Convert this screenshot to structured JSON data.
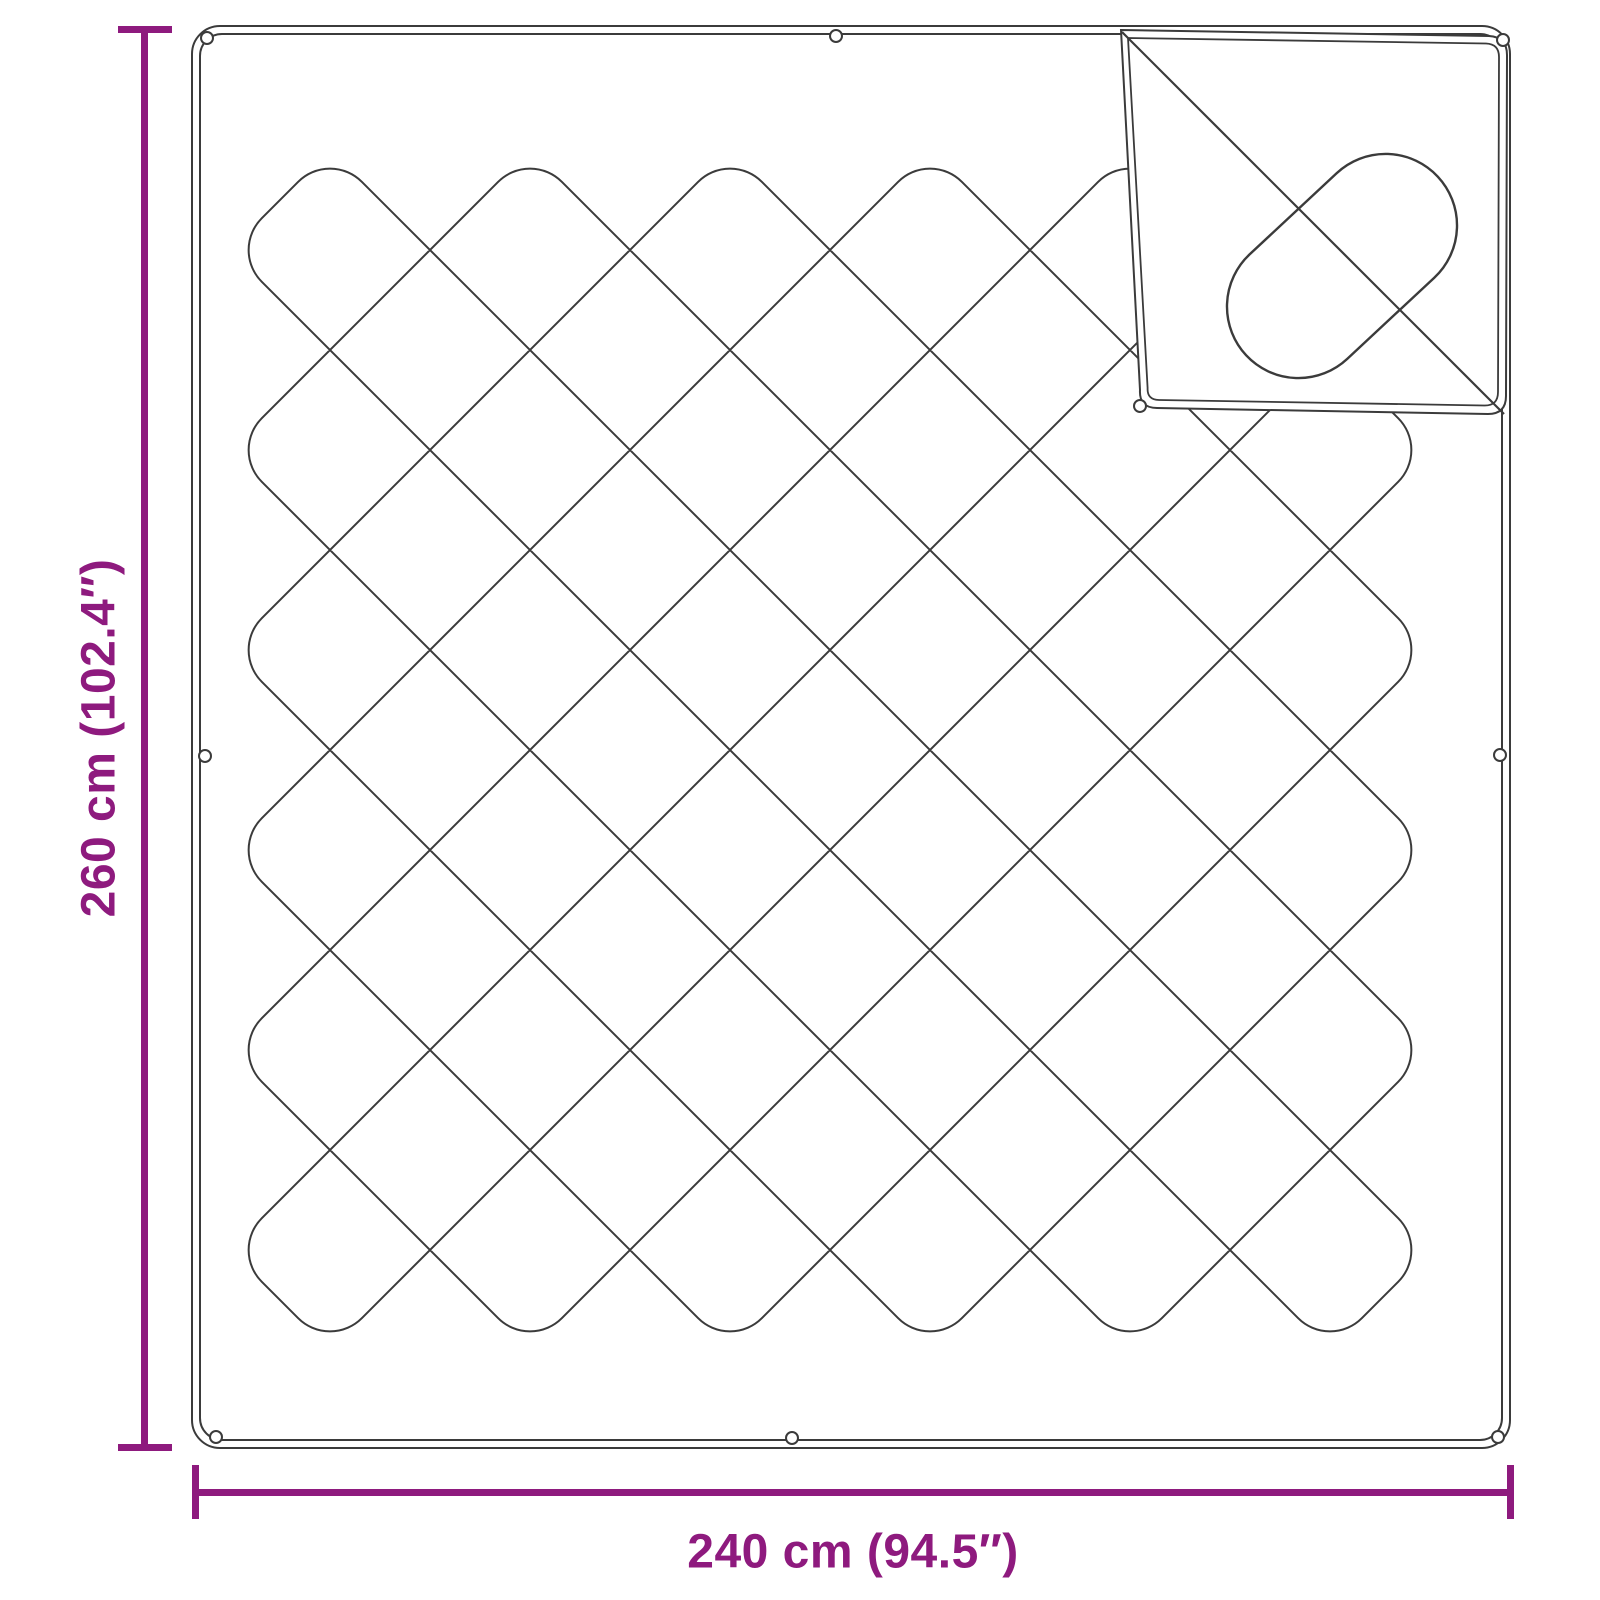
{
  "diagram": {
    "type": "product-dimension-diagram",
    "subject": "quilted blanket, top view, with folded corner showing reverse side",
    "colors": {
      "accent": "#8E1A7E",
      "outline": "#3B3B3B",
      "background": "#FFFFFF"
    },
    "dimensions": {
      "height": {
        "label": "260 cm (102.4″)",
        "cm": 260,
        "inches": 102.4,
        "orientation": "vertical"
      },
      "width": {
        "label": "240 cm (94.5″)",
        "cm": 240,
        "inches": 94.5,
        "orientation": "horizontal"
      }
    },
    "pattern": {
      "style": "diamond quilting with rounded edge turns",
      "snap_fastener_count": 9,
      "folded_corner": "top-right"
    }
  }
}
